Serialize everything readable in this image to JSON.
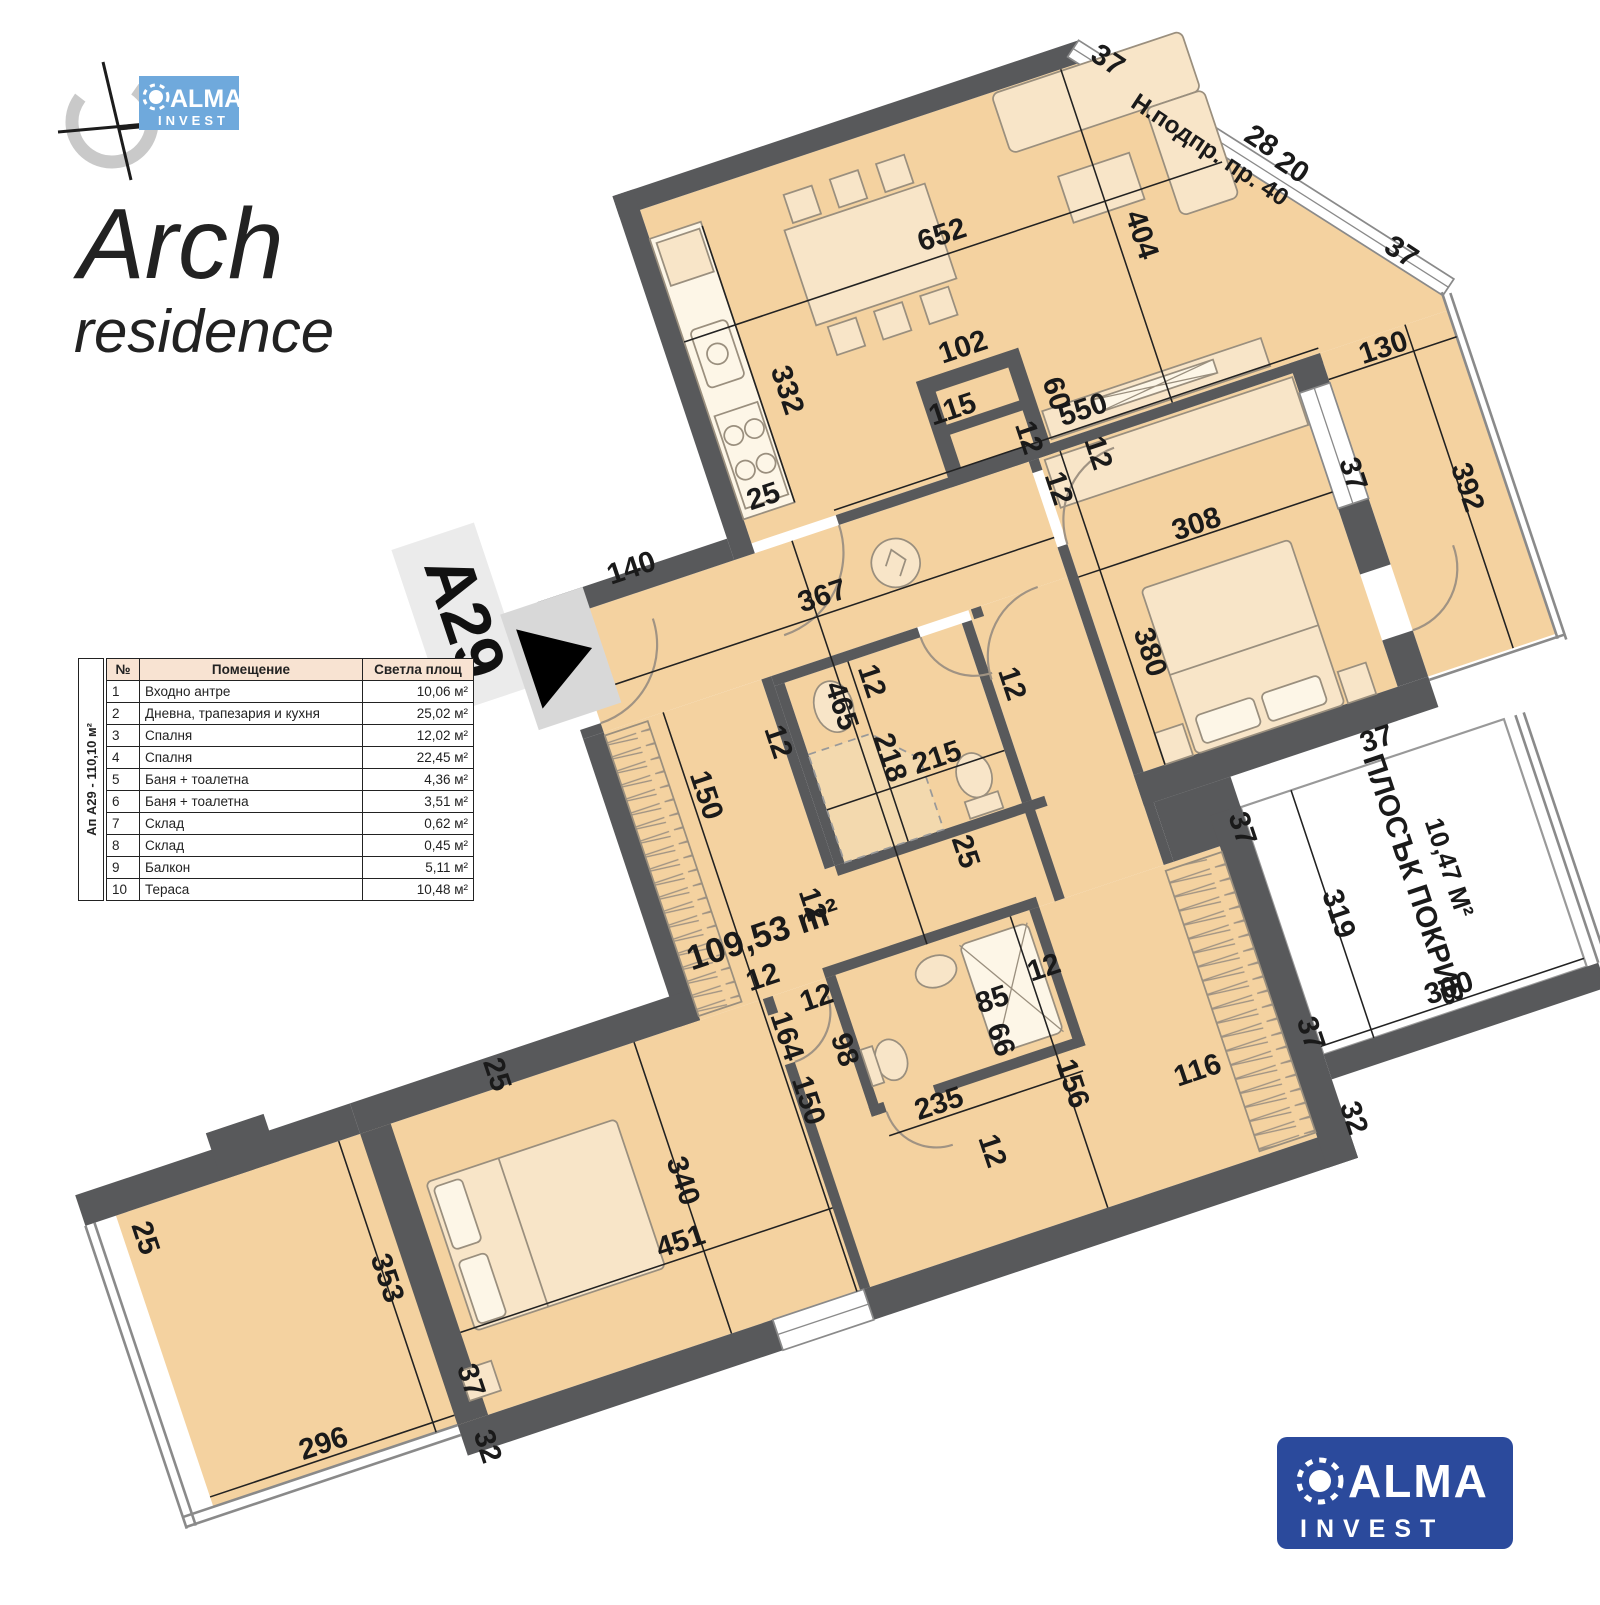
{
  "branding": {
    "project_title": "Arch",
    "project_subtitle": "residence",
    "logo_alma": "ALMA",
    "logo_invest": "INVEST"
  },
  "unit_label": {
    "id": "А29"
  },
  "table": {
    "vertical_label": "Ап А29 - 110,10 м²",
    "headers": [
      "№",
      "Помещение",
      "Светла площ"
    ],
    "rows": [
      [
        "1",
        "Входно антре",
        "10,06 м²"
      ],
      [
        "2",
        "Дневна, трапезария и кухня",
        "25,02 м²"
      ],
      [
        "3",
        "Спалня",
        "12,02 м²"
      ],
      [
        "4",
        "Спалня",
        "22,45 м²"
      ],
      [
        "5",
        "Баня + тоалетна",
        "4,36 м²"
      ],
      [
        "6",
        "Баня + тоалетна",
        "3,51 м²"
      ],
      [
        "7",
        "Склад",
        "0,62 м²"
      ],
      [
        "8",
        "Склад",
        "0,45 м²"
      ],
      [
        "9",
        "Балкон",
        "5,11 м²"
      ],
      [
        "10",
        "Тераса",
        "10,48 м²"
      ]
    ]
  },
  "plan": {
    "area_label": "109,53 m²",
    "window_note": "Н.подпр. пр. 40",
    "roof_label": {
      "line1": "ПЛОСЪК ПОКРИВ",
      "line2": "10,47 М²"
    },
    "colors": {
      "wall": "#58595b",
      "room": "#f4d2a0",
      "furniture": "#f8e5c8",
      "logo_blue_dark": "#2b4a9c",
      "logo_blue_light": "#6fa9dc"
    },
    "dimensions": [
      {
        "t": "652",
        "x": 320,
        "y": 148,
        "r": 0
      },
      {
        "t": "404",
        "x": 527,
        "y": 210,
        "r": 90
      },
      {
        "t": "550",
        "x": 410,
        "y": 390,
        "r": 0
      },
      {
        "t": "25",
        "x": 30,
        "y": 368,
        "r": 0
      },
      {
        "t": "332",
        "x": 84,
        "y": 250,
        "r": 90
      },
      {
        "t": "102",
        "x": 302,
        "y": 278,
        "r": 0
      },
      {
        "t": "115",
        "x": 268,
        "y": 342,
        "r": 0
      },
      {
        "t": "60",
        "x": 376,
        "y": 352,
        "r": 90
      },
      {
        "t": "12",
        "x": 400,
        "y": 432,
        "r": 90
      },
      {
        "t": "37",
        "x": 556,
        "y": 14,
        "r": 52
      },
      {
        "t": "28",
        "x": 694,
        "y": 158,
        "r": 52
      },
      {
        "t": "20",
        "x": 718,
        "y": 198,
        "r": 52
      },
      {
        "t": "37",
        "x": 806,
        "y": 330,
        "r": 52
      },
      {
        "t": "Н.подпр. пр. 40",
        "x": 636,
        "y": 148,
        "r": 52,
        "s": 28
      },
      {
        "t": "12",
        "x": 330,
        "y": 390,
        "r": 90
      },
      {
        "t": "308",
        "x": 492,
        "y": 556,
        "r": 0
      },
      {
        "t": "380",
        "x": 384,
        "y": 668,
        "r": 90
      },
      {
        "t": "37",
        "x": 670,
        "y": 548,
        "r": 90
      },
      {
        "t": "12",
        "x": 344,
        "y": 456,
        "r": 90
      },
      {
        "t": "130",
        "x": 760,
        "y": 432,
        "r": 0
      },
      {
        "t": "392",
        "x": 790,
        "y": 604,
        "r": 90
      },
      {
        "t": "37",
        "x": 610,
        "y": 856,
        "r": 0
      },
      {
        "t": "140",
        "x": -140,
        "y": 398,
        "r": 0
      },
      {
        "t": "367",
        "x": 58,
        "y": 498,
        "r": 0
      },
      {
        "t": "465",
        "x": 28,
        "y": 614,
        "r": 90
      },
      {
        "t": "150",
        "x": -152,
        "y": 662,
        "r": 90
      },
      {
        "t": "12",
        "x": -54,
        "y": 630,
        "r": 90
      },
      {
        "t": "109,53 m²",
        "x": -130,
        "y": 848,
        "r": 0,
        "s": 40
      },
      {
        "t": "12",
        "x": 70,
        "y": 598,
        "r": 90
      },
      {
        "t": "218",
        "x": 62,
        "y": 688,
        "r": 90
      },
      {
        "t": "215",
        "x": 124,
        "y": 716,
        "r": 0
      },
      {
        "t": "12",
        "x": 222,
        "y": 652,
        "r": 90
      },
      {
        "t": "25",
        "x": 110,
        "y": 818,
        "r": 90
      },
      {
        "t": "12",
        "x": -76,
        "y": 820,
        "r": 90
      },
      {
        "t": "164",
        "x": -152,
        "y": 954,
        "r": 90
      },
      {
        "t": "150",
        "x": -152,
        "y": 1032,
        "r": 90
      },
      {
        "t": "12",
        "x": -146,
        "y": 892,
        "r": 0
      },
      {
        "t": "25",
        "x": -482,
        "y": 890,
        "r": 90
      },
      {
        "t": "340",
        "x": -318,
        "y": 1074,
        "r": 90
      },
      {
        "t": "451",
        "x": -332,
        "y": 1150,
        "r": 0
      },
      {
        "t": "37",
        "x": -622,
        "y": 1214,
        "r": 90
      },
      {
        "t": "32",
        "x": -628,
        "y": 1292,
        "r": 90
      },
      {
        "t": "296",
        "x": -795,
        "y": 1240,
        "r": 0
      },
      {
        "t": "353",
        "x": -676,
        "y": 1072,
        "r": 90
      },
      {
        "t": "25",
        "x": -925,
        "y": 940,
        "r": 90
      },
      {
        "t": "12",
        "x": -95,
        "y": 934,
        "r": 0
      },
      {
        "t": "98",
        "x": -94,
        "y": 990,
        "r": 90
      },
      {
        "t": "85",
        "x": 96,
        "y": 1000,
        "r": 0
      },
      {
        "t": "66",
        "x": 80,
        "y": 1036,
        "r": 90
      },
      {
        "t": "12",
        "x": 164,
        "y": 984,
        "r": 0
      },
      {
        "t": "235",
        "x": 0,
        "y": 1094,
        "r": 0
      },
      {
        "t": "156",
        "x": 142,
        "y": 1110,
        "r": 90
      },
      {
        "t": "12",
        "x": 30,
        "y": 1154,
        "r": 90
      },
      {
        "t": "116",
        "x": 294,
        "y": 1152,
        "r": 0
      },
      {
        "t": "37",
        "x": 420,
        "y": 1142,
        "r": 90
      },
      {
        "t": "37",
        "x": 420,
        "y": 894,
        "r": 90
      },
      {
        "t": "319",
        "x": 494,
        "y": 1022,
        "r": 90
      },
      {
        "t": "300",
        "x": 598,
        "y": 1154,
        "r": 0
      },
      {
        "t": "32",
        "x": 436,
        "y": 1250,
        "r": 90
      }
    ]
  }
}
